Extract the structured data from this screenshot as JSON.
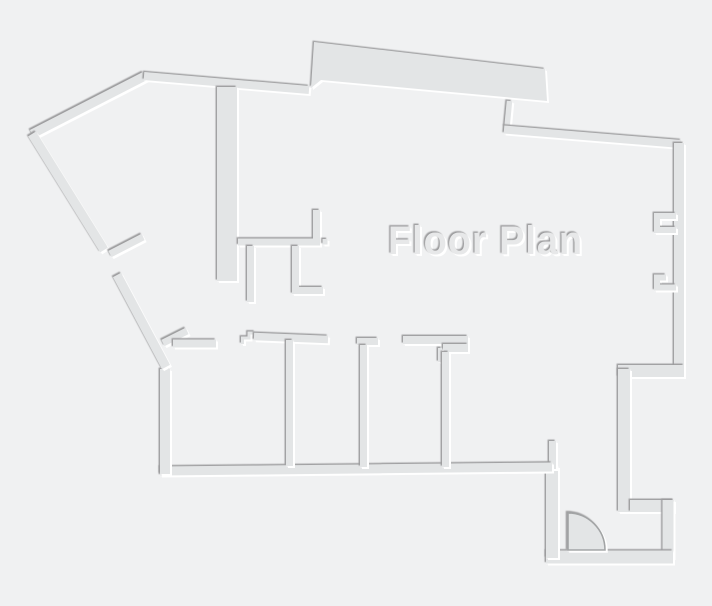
{
  "style": {
    "background": "#f0f1f2",
    "wall_fill": "#e3e5e6",
    "shadow_dark": "#9b9b9d",
    "shadow_light": "#ffffff",
    "title_fill": "#e7e8e9",
    "door_outline": "#a2a4a5"
  },
  "floor_plan": {
    "title": "Floor Plan",
    "walls": [
      {
        "name": "outer-wall-diagonal-upper-left",
        "line": [
          32,
          134,
          145,
          76
        ],
        "w": 9
      },
      {
        "name": "outer-wall-top",
        "line": [
          144,
          76,
          309,
          90
        ],
        "w": 8
      },
      {
        "name": "outer-wall-top-slab",
        "path": "M314,42 L545,69 L547,101 L321,80 L311,88 Z",
        "filled": true
      },
      {
        "name": "outer-wall-slab-connector",
        "line": [
          509.5,
          101,
          507,
          127
        ],
        "w": 5.5
      },
      {
        "name": "outer-wall-top-right",
        "line": [
          504,
          129.5,
          681,
          144
        ],
        "w": 8
      },
      {
        "name": "outer-wall-right",
        "line": [
          679,
          143,
          679,
          372
        ],
        "w": 10
      },
      {
        "name": "window-notch-upper",
        "path": "M676,216 L657,216 L657,230 L676,230",
        "w": 6
      },
      {
        "name": "window-notch-lower",
        "path": "M666,277.5 L657,277.5 L657,287.5 L676,287.5",
        "w": 6
      },
      {
        "name": "outer-wall-right-step",
        "line": [
          618,
          371,
          684,
          371
        ],
        "w": 12
      },
      {
        "name": "outer-wall-right-lower",
        "line": [
          624,
          369,
          624,
          512
        ],
        "w": 12
      },
      {
        "name": "outer-wall-corner-top",
        "line": [
          630,
          506,
          674,
          506
        ],
        "w": 12
      },
      {
        "name": "outer-wall-corner-right",
        "line": [
          668,
          500,
          668,
          558
        ],
        "w": 11
      },
      {
        "name": "outer-wall-bottom-right",
        "line": [
          546,
          557,
          673,
          557
        ],
        "w": 13
      },
      {
        "name": "entry-corridor-wall",
        "line": [
          552,
          466,
          552,
          558
        ],
        "w": 12
      },
      {
        "name": "entry-door-jamb",
        "line": [
          552.5,
          441,
          552.5,
          469
        ],
        "w": 7
      },
      {
        "name": "outer-wall-bottom",
        "line": [
          160,
          471,
          552,
          467
        ],
        "w": 9
      },
      {
        "name": "outer-wall-left-lower",
        "line": [
          165,
          369,
          165,
          474
        ],
        "w": 10
      },
      {
        "name": "outer-wall-diagonal-lower-left",
        "line": [
          117,
          275,
          166,
          367
        ],
        "w": 9
      },
      {
        "name": "outer-wall-diagonal-mid-left",
        "line": [
          32,
          134,
          104,
          250
        ],
        "w": 9
      },
      {
        "name": "partition-stub-doorway",
        "line": [
          110,
          254,
          143,
          237
        ],
        "w": 7
      },
      {
        "name": "partition-stub-corner",
        "line": [
          163,
          343,
          187,
          331
        ],
        "w": 7
      },
      {
        "name": "interior-wall-thick-vertical",
        "line": [
          227,
          87,
          227,
          281
        ],
        "w": 20
      },
      {
        "name": "closet-wall-l",
        "path": "M316.5,210 L316.5,242 L238,242",
        "w": 7
      },
      {
        "name": "door-stop-dot",
        "rect": [
          322.5,
          239,
          5,
          5.5
        ]
      },
      {
        "name": "closet-stub-a",
        "line": [
          250.5,
          246,
          250.5,
          302
        ],
        "w": 7
      },
      {
        "name": "closet-stub-b",
        "path": "M295.5,246 L295.5,290.5 L323,290.5",
        "w": 7
      },
      {
        "name": "room-wall-top-a",
        "line": [
          173,
          343.5,
          216,
          343.5
        ],
        "w": 8
      },
      {
        "name": "threshold-steps",
        "path": "M242.5,344 L242.5,338 L249,338 L249,333 L255,333",
        "w": 3
      },
      {
        "name": "room-wall-top-b",
        "line": [
          254,
          336.5,
          328,
          339.5
        ],
        "w": 7.5
      },
      {
        "name": "room-divider-1",
        "line": [
          289.5,
          340,
          289.5,
          466
        ],
        "w": 7
      },
      {
        "name": "room-wall-cap-2",
        "line": [
          357,
          341.5,
          378,
          341.5
        ],
        "w": 7
      },
      {
        "name": "room-divider-2",
        "line": [
          363.5,
          345,
          363.5,
          467
        ],
        "w": 7
      },
      {
        "name": "room-wall-cap-3",
        "line": [
          403,
          340,
          468,
          340
        ],
        "w": 8
      },
      {
        "name": "room-wall-cap-3-block",
        "rect": [
          443,
          344,
          25,
          8
        ]
      },
      {
        "name": "door-jamb-stub",
        "rect": [
          438,
          348,
          4,
          14
        ]
      },
      {
        "name": "room-divider-3",
        "line": [
          445.5,
          352,
          445.5,
          467
        ],
        "w": 7
      },
      {
        "name": "entry-door-swing",
        "path": "M568,550 L568,513 A37,37 0 0 1 605,550 Z",
        "filled": true,
        "outlined": true
      }
    ]
  }
}
